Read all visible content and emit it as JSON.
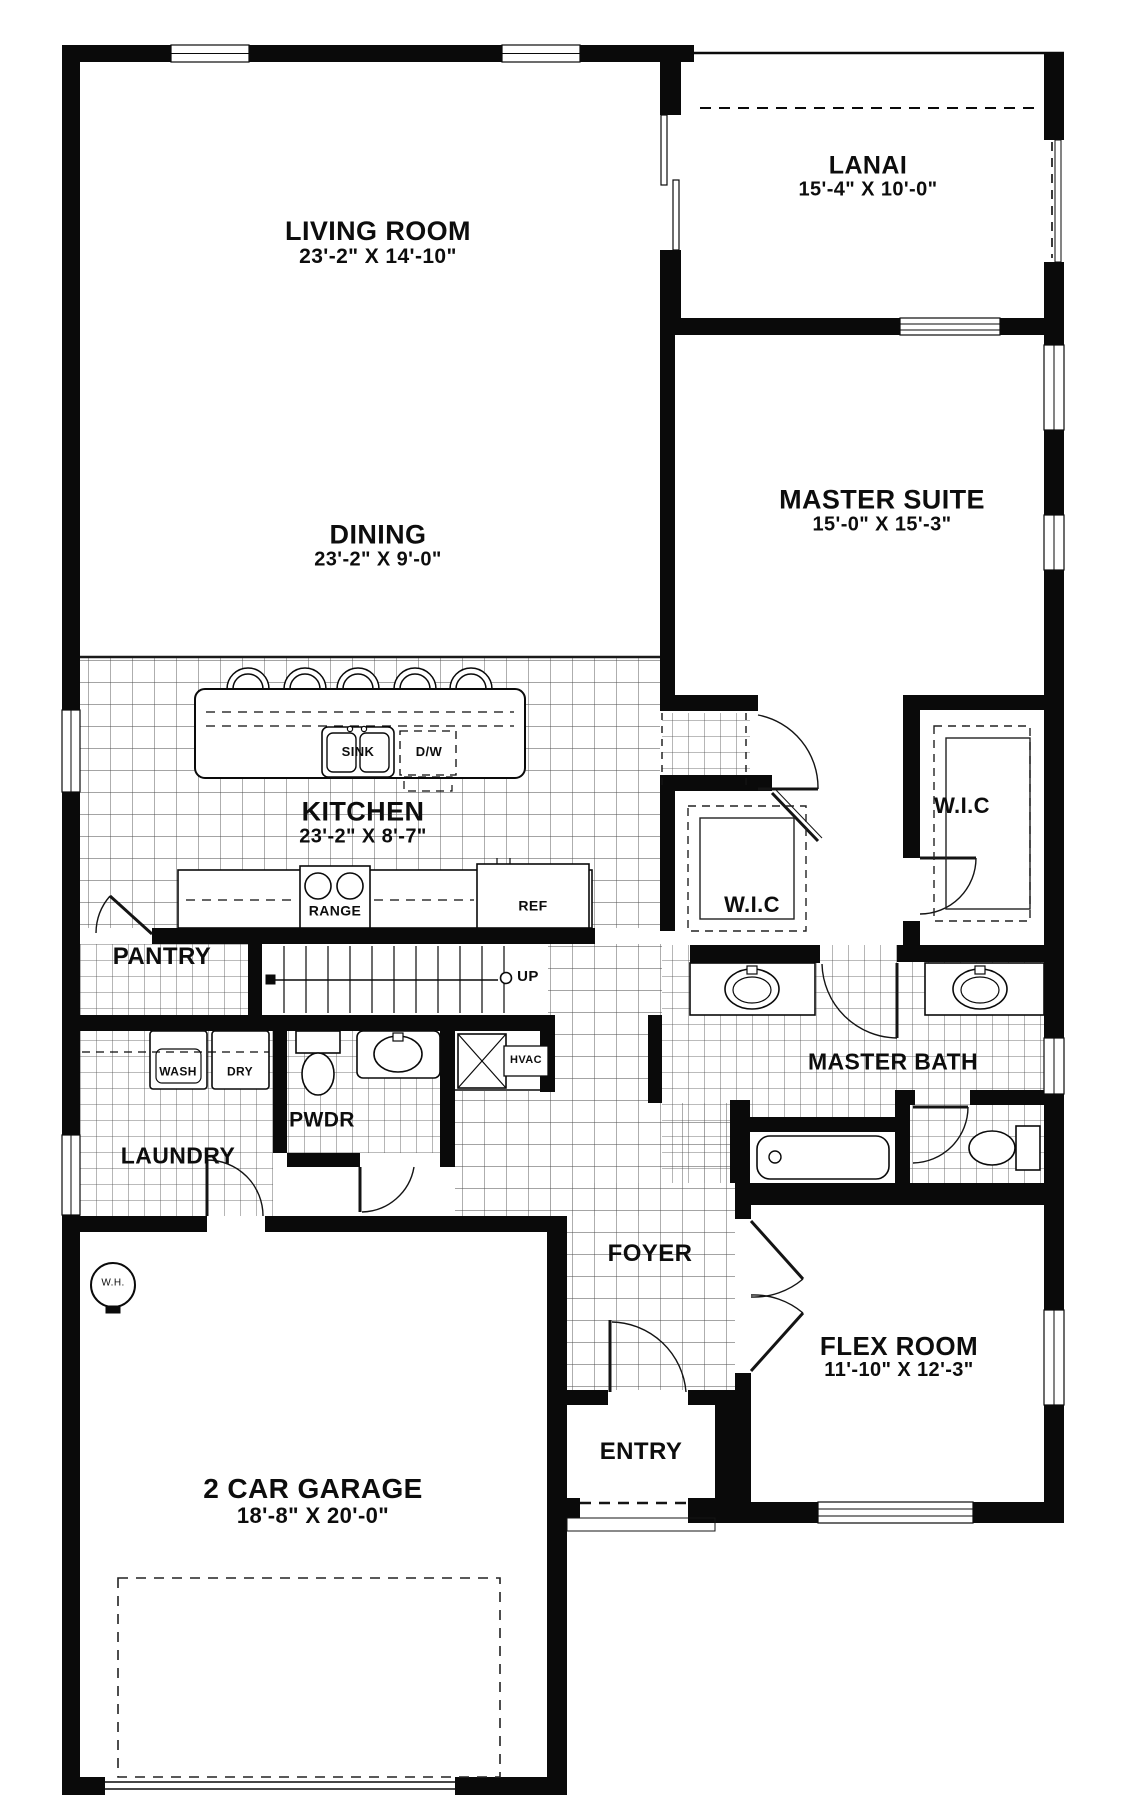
{
  "rooms": {
    "living": {
      "name": "LIVING ROOM",
      "dims": "23'-2\" X 14'-10\""
    },
    "lanai": {
      "name": "LANAI",
      "dims": "15'-4\" X 10'-0\""
    },
    "master": {
      "name": "MASTER SUITE",
      "dims": "15'-0\" X 15'-3\""
    },
    "dining": {
      "name": "DINING",
      "dims": "23'-2\" X 9'-0\""
    },
    "kitchen": {
      "name": "KITCHEN",
      "dims": "23'-2\" X 8'-7\""
    },
    "pantry": {
      "name": "PANTRY"
    },
    "wic_left": {
      "name": "W.I.C"
    },
    "wic_right": {
      "name": "W.I.C"
    },
    "master_bath": {
      "name": "MASTER BATH"
    },
    "laundry": {
      "name": "LAUNDRY"
    },
    "pwdr": {
      "name": "PWDR"
    },
    "foyer": {
      "name": "FOYER"
    },
    "flex": {
      "name": "FLEX ROOM",
      "dims": "11'-10\" X 12'-3\""
    },
    "entry": {
      "name": "ENTRY"
    },
    "garage": {
      "name": "2 CAR GARAGE",
      "dims": "18'-8\" X 20'-0\""
    }
  },
  "fixtures": {
    "sink": "SINK",
    "dishwasher": "D/W",
    "range": "RANGE",
    "refrigerator": "REF",
    "washer": "WASH",
    "dryer": "DRY",
    "hvac": "HVAC",
    "water_heater": "W.H.",
    "stairs_up": "UP"
  },
  "colors": {
    "wall": "#0a0a0a",
    "tile_line": "#474747",
    "background": "#ffffff"
  }
}
